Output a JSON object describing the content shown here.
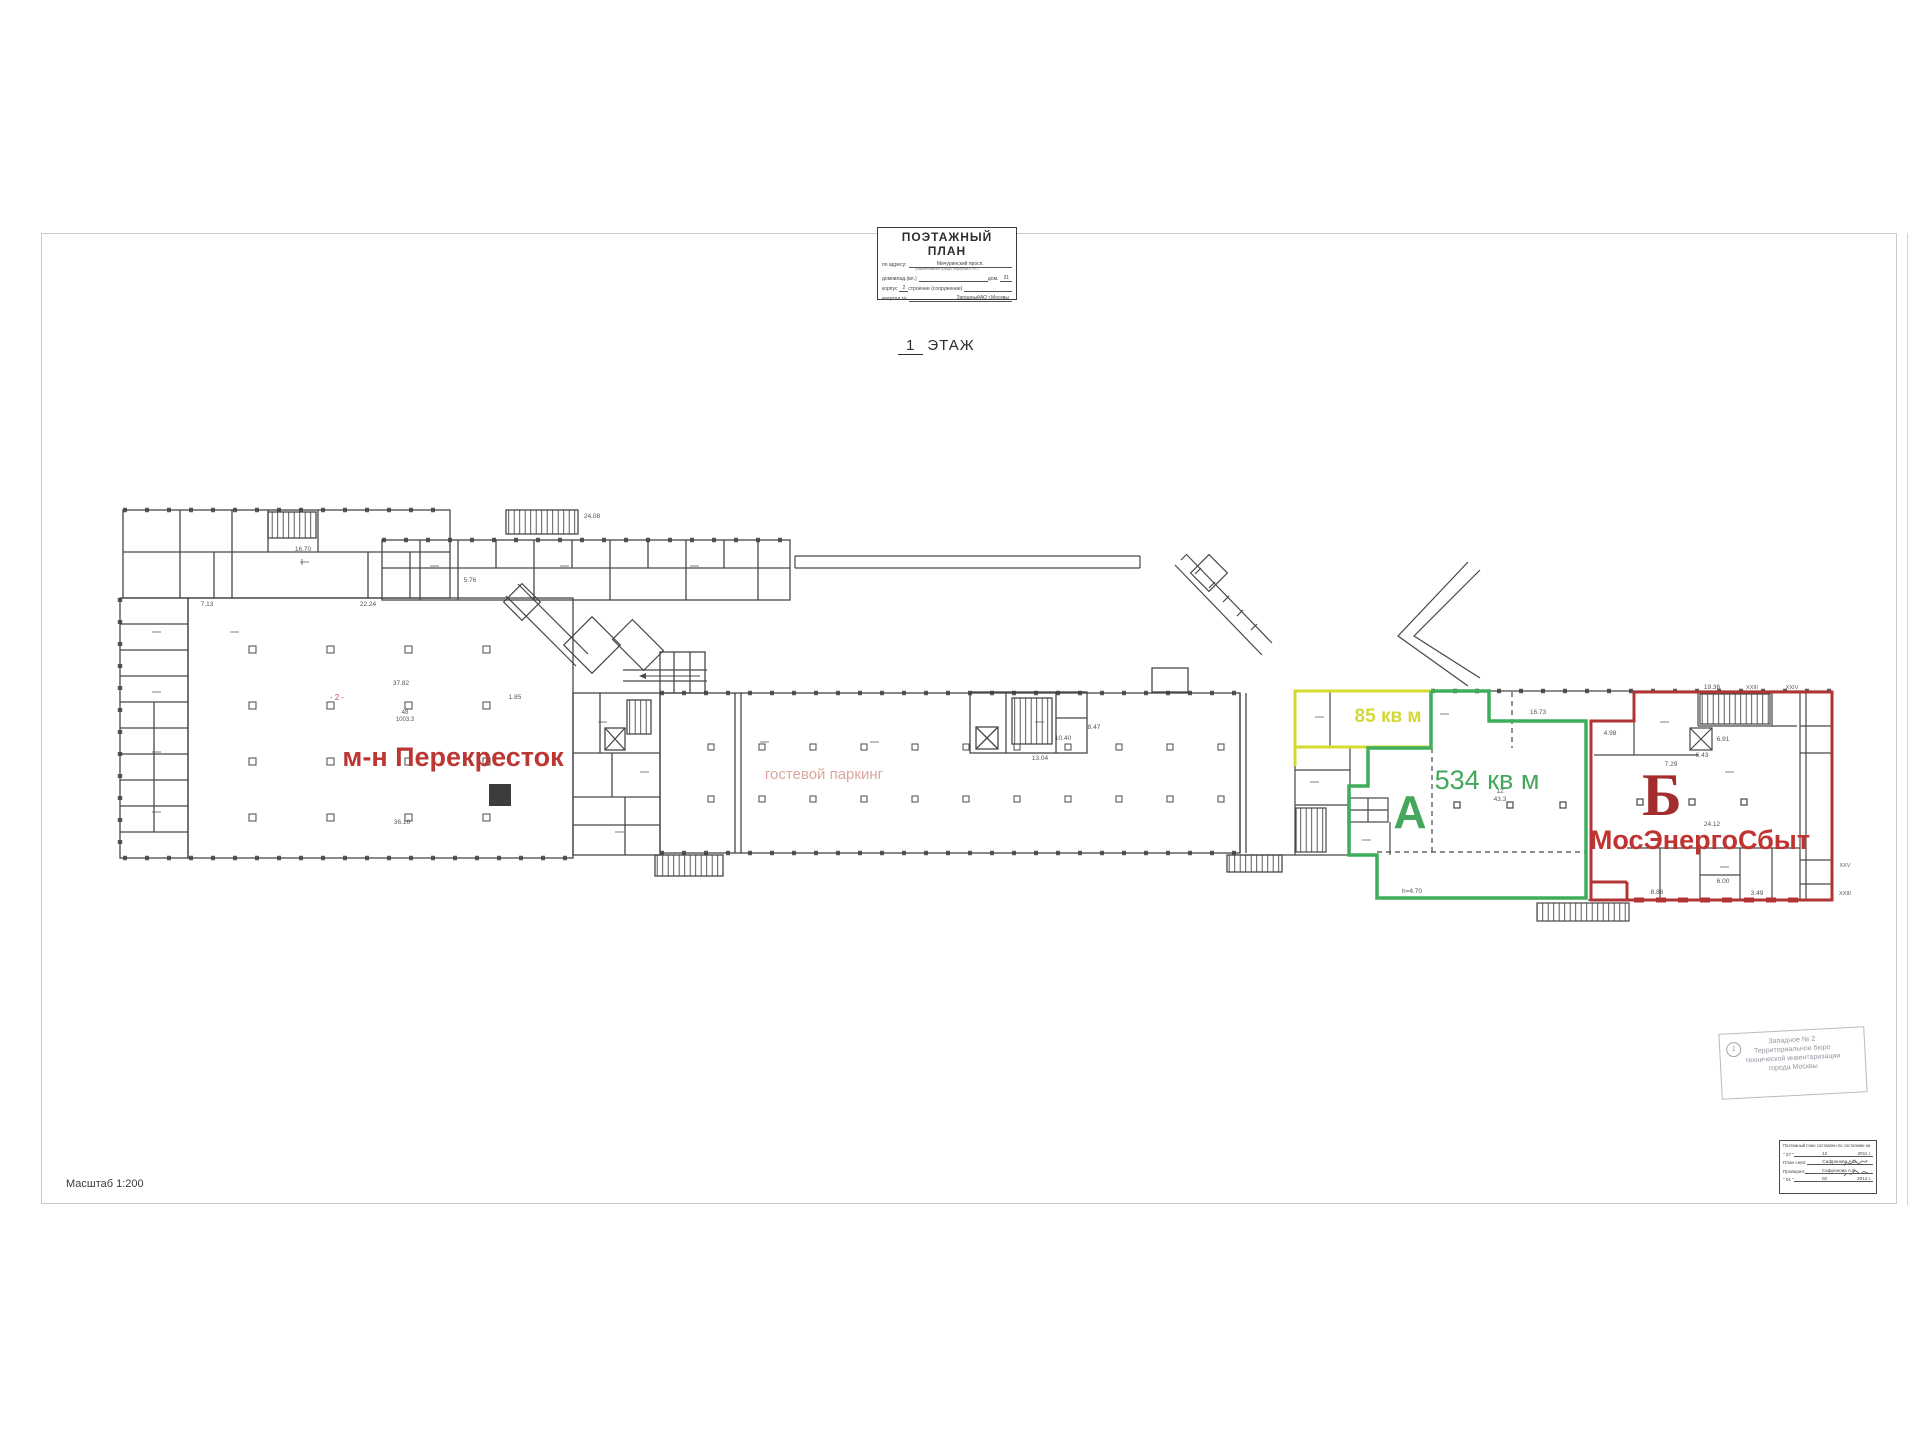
{
  "sheet": {
    "scale_label": "Масштаб 1:200",
    "floor_num": "1",
    "floor_word": "ЭТАЖ",
    "title_block": {
      "title": "ПОЭТАЖНЫЙ ПЛАН",
      "address_label": "по адресу:",
      "address_value": "Мичуринский просп.",
      "address_note": "(наименование улицы, переулка и т.п.)",
      "row2_label1": "домовлад.(вл.)",
      "row2_label2": "дом.",
      "row2_value2": "31",
      "row3_label1": "корпус",
      "row3_value1": "2",
      "row3_label2": "строение (сооружение)",
      "row4_label1": "квартал №",
      "row4_value2": "ЗападныйАО г.Москвы"
    }
  },
  "plan": {
    "labels": {
      "perekrestok": "м-н Перекресток",
      "parking": "гостевой паркинг",
      "area85": "85 кв м",
      "a_letter": "А",
      "area534": "534 кв м",
      "b_letter": "Б",
      "mosenergosbyt": "МосЭнергоСбыт",
      "hall_room_no": "48",
      "hall_room_area": "1003.3",
      "red_mark": "- 2 -"
    },
    "colors": {
      "section_a": "#3fae5c",
      "section_b": "#b03434",
      "area_85": "#d3d838",
      "perekrestok": "#bc3634",
      "parking_text": "#d9a79e"
    },
    "dims": {
      "d_24_08": "24.08",
      "d_16_70": "16.70",
      "d_22_24": "22.24",
      "d_37_82": "37.82",
      "d_5_76": "5.76",
      "d_7_13": "7.13",
      "d_36_16": "36.16",
      "d_1_85": "1.85",
      "d_13_04": "13.04",
      "d_10_40": "10.40",
      "d_8_47": "8.47",
      "d_16_73": "16.73",
      "d_4_98": "4.98",
      "d_h": "h=4.70",
      "d_12": "12",
      "d_43_3": "43.3",
      "d_6_91": "6.91",
      "d_6_43": "6.43",
      "d_24_12": "24.12",
      "d_7_29": "7.29",
      "d_8_86": "8.86",
      "d_6_00": "6.00",
      "d_3_49": "3.49",
      "d_19_36": "19.36",
      "ax1": "XXIII",
      "ax2": "XXIV",
      "ax3": "XXV",
      "ax4": "XXIII"
    }
  },
  "stamp": {
    "number": "1",
    "line1": "Западное № 2",
    "line2": "Территориальное бюро",
    "line3": "технической инвентаризации",
    "line4": "города Москвы"
  },
  "signoff": {
    "header": "Поэтажный план составлен по состоянию на",
    "date1_prefix": "\" 27 \"",
    "date1_month": "12",
    "date1_year": "2011 г.",
    "surveyor_label": "План снял:",
    "surveyor_value": "Сафронова А.В.",
    "checker_label": "Проверил:",
    "checker_value": "Сафронова А.Е.",
    "date2_prefix": "\" 01 \"",
    "date2_month": "02",
    "date2_year": "2012 г."
  }
}
